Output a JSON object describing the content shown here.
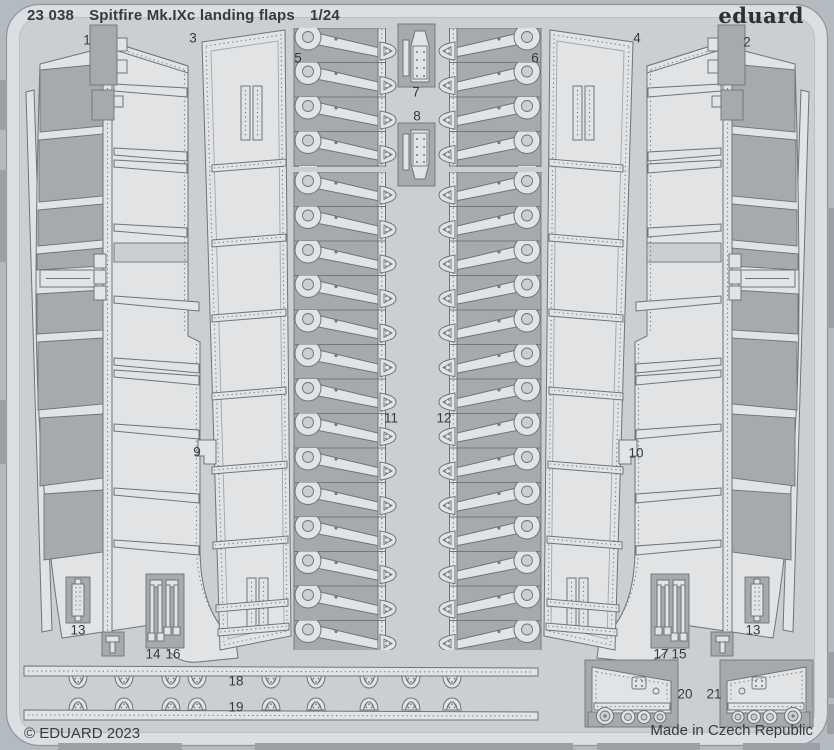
{
  "header": {
    "catalog_number": "23 038",
    "title": "Spitfire Mk.IXc landing flaps",
    "scale": "1/24",
    "brand": "eduard"
  },
  "footer": {
    "copyright": "© EDUARD 2023",
    "made_in": "Made in Czech Republic"
  },
  "colors": {
    "page_bg": "#b3bac0",
    "frame_band": "#dcdfe1",
    "frame_edge": "#8f959a",
    "frame_edge2": "#b9bfc3",
    "inner_bg": "#cbcfd3",
    "part_light": "#e1e3e5",
    "part_dark": "#a5aaad",
    "outline": "#6e7477",
    "dot": "#74797d",
    "tab": "#9aa0a5",
    "text": "#363b3f"
  },
  "part_labels": [
    {
      "text": "1"
    },
    {
      "text": "3"
    },
    {
      "text": "5"
    },
    {
      "text": "7"
    },
    {
      "text": "8"
    },
    {
      "text": "6"
    },
    {
      "text": "4"
    },
    {
      "text": "2"
    },
    {
      "text": "9"
    },
    {
      "text": "11"
    },
    {
      "text": "12"
    },
    {
      "text": "10"
    },
    {
      "text": "13"
    },
    {
      "text": "14"
    },
    {
      "text": "16"
    },
    {
      "text": "17"
    },
    {
      "text": "15"
    },
    {
      "text": "13"
    },
    {
      "text": "18"
    },
    {
      "text": "19"
    },
    {
      "text": "20"
    },
    {
      "text": "21"
    }
  ]
}
